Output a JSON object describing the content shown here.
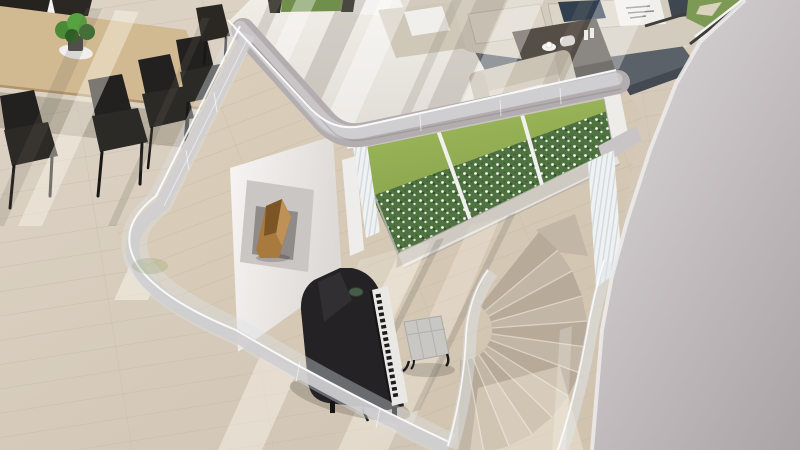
{
  "scene": {
    "type": "architectural-interior-render",
    "view": "overhead view of a double-height modern living space with mezzanine, glass balustrade, grand piano, curved staircase and garden window",
    "description": "Top-down 3D rendering: upper mezzanine with wooden dining table, dark chairs and beige lounge suite around a slate rug; a curved glass balustrade rings the double-height void below, where a black grand piano with bench stands on pale wood flooring beside a white fireplace wall holding a wooden sculpture; a floor-to-ceiling window shows a sunlit lawn and white-flowering hedge; a carpeted staircase curves down past sheer curtains beside a large light-grey wall."
  },
  "objects": [
    {
      "name": "dining-table",
      "label": "wooden dining table"
    },
    {
      "name": "dining-chair",
      "label": "dark dining chair"
    },
    {
      "name": "potted-plant",
      "label": "green potted plant"
    },
    {
      "name": "sofa",
      "label": "beige modular sofa"
    },
    {
      "name": "throw-pillow",
      "label": "throw pillows"
    },
    {
      "name": "coffee-table",
      "label": "dark wood coffee table"
    },
    {
      "name": "tea-set",
      "label": "white tea set"
    },
    {
      "name": "armchair",
      "label": "beige armchair"
    },
    {
      "name": "area-rug",
      "label": "slate grey rug"
    },
    {
      "name": "mezzanine-fascia",
      "label": "curved grey floor-edge band"
    },
    {
      "name": "glass-balustrade",
      "label": "curved frameless glass balustrade"
    },
    {
      "name": "fireplace-wall",
      "label": "white feature wall with recess"
    },
    {
      "name": "wood-sculpture",
      "label": "angular wooden sculpture in recess"
    },
    {
      "name": "window-wall",
      "label": "floor-to-ceiling garden window"
    },
    {
      "name": "lawn",
      "label": "green lawn"
    },
    {
      "name": "garden-hedge",
      "label": "hedge with white flowers"
    },
    {
      "name": "sheer-curtain",
      "label": "white sheer curtains"
    },
    {
      "name": "grand-piano",
      "label": "black grand piano"
    },
    {
      "name": "piano-bench",
      "label": "tufted piano bench"
    },
    {
      "name": "curved-staircase",
      "label": "curved carpeted staircase"
    },
    {
      "name": "wood-floor",
      "label": "pale oak plank flooring"
    },
    {
      "name": "tile-floor",
      "label": "light tiled floor"
    },
    {
      "name": "structural-wall",
      "label": "large light-grey wall"
    }
  ],
  "colors": {
    "woodUpper": "#d8cdbc",
    "woodLower": "#d5cab7",
    "tile": "#ece9e2",
    "fascia": "#b3adaf",
    "fasciaLight": "#c9c4c5",
    "wallLightEdge": "#eceae9",
    "rug": "#5b6168",
    "rugDark": "#434a52",
    "sofa": "#d3ccbe",
    "cushion": "#dcd5c7",
    "pillowNavy": "#31404f",
    "pillowWhite": "#f1efeb",
    "tableWood": "#d1b992",
    "chairDark": "#2c2a27",
    "coffeeTable": "#554e47",
    "grass": "#96b053",
    "hedge": "#4f7340",
    "curtain": "#e9edee",
    "fireplaceWall": "#f3f1ef",
    "insetPanel": "#cac6c4",
    "woodSculpture": "#a87a3e",
    "piano": "#242225",
    "pianoKeys": "#eae8e4",
    "bench": "#c9c7c3",
    "stepA": "#c2b6a6",
    "stepB": "#b7aa99",
    "beamWhite": "#f3f1ee",
    "sill": "#e6e2db",
    "plantGreen": "#4c8a38"
  }
}
